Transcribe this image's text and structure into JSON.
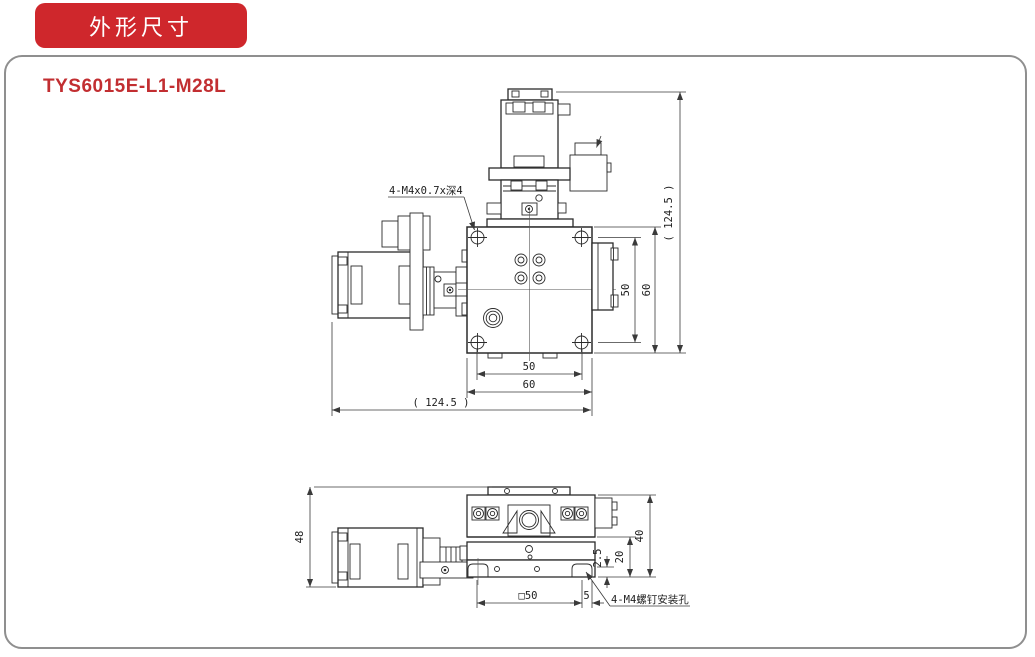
{
  "header": {
    "badge": "外形尺寸",
    "model": "TYS6015E-L1-M28L"
  },
  "colors": {
    "accent_red": "#CF272C",
    "model_red": "#C22E31",
    "line_dark": "#2b2b2b",
    "panel_border": "#8f8f8f"
  },
  "top_view": {
    "thread_note": "4-M4x0.7x深4",
    "dims": {
      "right_inner": "50",
      "right_outer": "60",
      "right_overall": "( 124.5 )",
      "bottom_inner": "50",
      "bottom_outer": "60",
      "bottom_overall": "( 124.5 )"
    }
  },
  "side_view": {
    "mount_note": "4-M4螺钉安装孔",
    "dims": {
      "overall_height": "48",
      "body_height": "40",
      "base_height": "20",
      "hole_offset": "2.5",
      "mount_square": "□50",
      "edge_offset": "5"
    }
  }
}
